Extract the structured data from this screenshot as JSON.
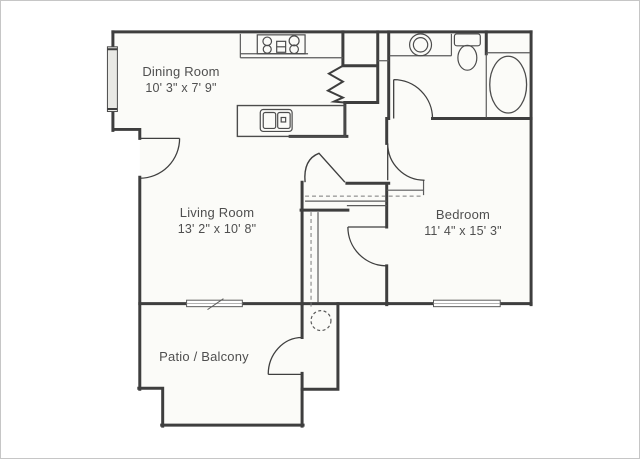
{
  "floorplan": {
    "rooms": [
      {
        "name": "Dining Room",
        "dims": "10' 3\" x 7' 9\""
      },
      {
        "name": "Living Room",
        "dims": "13' 2\" x 10' 8\""
      },
      {
        "name": "Bedroom",
        "dims": "11' 4\" x 15' 3\""
      },
      {
        "name": "Patio / Balcony",
        "dims": ""
      }
    ],
    "fixtures": [
      "stove",
      "kitchen-island-sink",
      "bathroom-sink",
      "toilet",
      "bathtub",
      "water-heater"
    ],
    "features": [
      "entry-door",
      "bathroom-door",
      "bedroom-door",
      "walk-in-closet-door",
      "patio-storage-door",
      "dining-window",
      "living-room-window",
      "bedroom-window",
      "pantry",
      "closet-shelves"
    ],
    "colors": {
      "wall": "#3e3e3e",
      "thin_line": "#5b5b5b",
      "floor": "#fbfbf8",
      "text": "#4f4f4f",
      "background": "#ffffff"
    }
  }
}
